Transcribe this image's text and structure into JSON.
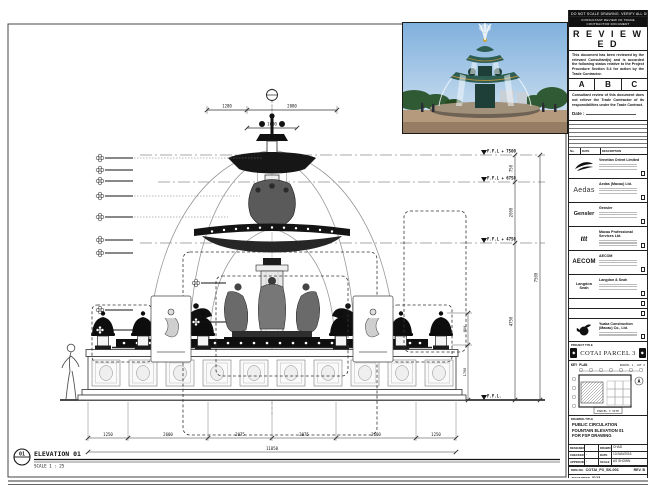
{
  "colors": {
    "paper": "#ffffff",
    "ink": "#111111",
    "sky": "#7fb0dd",
    "patina": "#2e5d52",
    "stone": "#b59a7e",
    "gold": "#c8a23c"
  },
  "top_note": "DO NOT SCALE DRAWING. VERIFY ALL DIMENSIONS ON SITE.",
  "reviewed_stamp": {
    "header": "CONSULTANT REVIEW OF TRADE CONTRACTOR DOCUMENT",
    "title": "R E V I E W E D",
    "body1": "This document has been reviewed by the relevant Consultant(s) and is accorded the following status relative to the Project Procedure Section 5.4 for action by the Trade Contractor.",
    "status_a": "A",
    "status_b": "B",
    "status_c": "C",
    "body2": "Consultant review of this document does not relieve the Trade Contractor of its responsibilities under the Trade Contract.",
    "date_label": "Date :"
  },
  "revision_table": {
    "col_no": "No.",
    "col_date": "DATE",
    "col_desc": "DESCRIPTION"
  },
  "consultants": [
    {
      "logo": "",
      "name": "Venetian Orient Limited"
    },
    {
      "logo": "Aedas",
      "name": "Aedas (Macau) Ltd."
    },
    {
      "logo": "Gensler",
      "name": "Gensler"
    },
    {
      "logo": "ttt",
      "name": "Macau Professional Services Ltd."
    },
    {
      "logo": "AECOM",
      "name": "AECOM"
    },
    {
      "logo": "Langdon Seah",
      "name": "Langdon & Seah"
    },
    {
      "logo": "",
      "name": ""
    },
    {
      "logo": "",
      "name": ""
    },
    {
      "logo": "",
      "name": "Yuaka Construction (Macau) Co., Ltd."
    }
  ],
  "project": {
    "label": "PROJECT TITLE",
    "name": "COTAI PARCEL 3"
  },
  "key_plan": {
    "label": "KEY PLAN",
    "parcel": "PARCEL 1, LOT 2",
    "site": "PARCEL 3 SITE"
  },
  "drawing_title": {
    "label": "DRAWING TITLE",
    "line1": "PUBLIC CIRCULATION",
    "line2": "FOUNTAIN ELEVATION 01",
    "line3": "FOR FSP DRAWING"
  },
  "approvals": {
    "designed_label": "DESIGNED",
    "designed": "",
    "drawn_label": "DRAWN",
    "drawn": "CHAD",
    "checked_label": "CHECKED",
    "checked": "-",
    "date_label": "DATE",
    "date": "12/JAN/2016",
    "approved_label": "APPROVED",
    "approved": "-",
    "scale_label": "SCALE",
    "scale": "AS SHOWN"
  },
  "dwg": {
    "label": "DWG NO.",
    "value": "COTAI_P3_SK-001",
    "rev": "REV. B"
  },
  "job": {
    "label": "JOB NUMBER",
    "value": "3123"
  },
  "cad": {
    "label": "CAD FILE NAME",
    "value": "COTAI_P3_SK-001.dwg"
  },
  "ref": {
    "label": "REFERENCE CAD FILE NAME(S)",
    "value": ""
  },
  "elevation_callout": {
    "number": "01",
    "title": "ELEVATION 01",
    "scale": "SCALE 1 : 25"
  },
  "levels": {
    "l1": "F.F.L + 7500",
    "l2": "F.F.L + 6750",
    "l3": "F.F.L + 4750",
    "l4": "F.F.L."
  },
  "dims": {
    "t1": "1280",
    "t2": "2880",
    "t3": "1600",
    "v1": "750",
    "v2": "2000",
    "v3": "4750",
    "v_overall": "7500",
    "lamp1": "950",
    "lamp2": "1700",
    "b1": "1250",
    "b2": "2600",
    "b3": "2075",
    "b4": "2075",
    "b5": "2600",
    "b6": "1250",
    "b_overall": "11850"
  }
}
